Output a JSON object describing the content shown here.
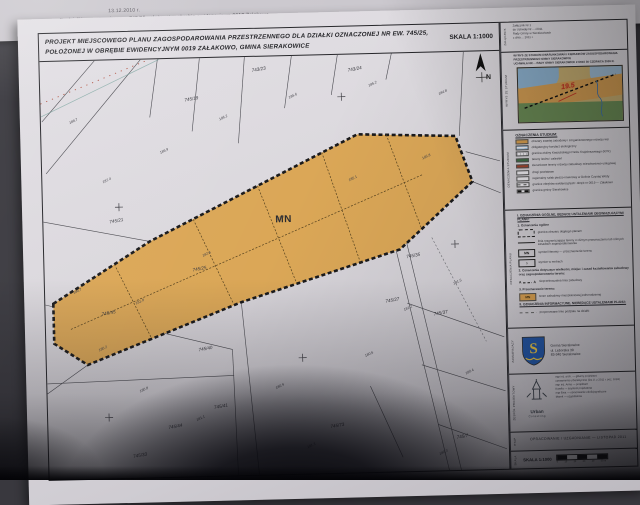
{
  "photo": {
    "back_sheet_lines": [
      "13.12.2010 r.",
      "dla działki oznaczonej nr ew. 745/25 położonej w obrębie ewidencyjnym 0019 Załakowo",
      "oraz Rozporządzenia Rady Ministrów z dnia 7 grudnia 2004 r. w sprawie sposobu i trybu ..."
    ]
  },
  "title_block": {
    "line1": "PROJEKT MIEJSCOWEGO PLANU ZAGOSPODAROWANIA PRZESTRZENNEGO DLA DZIAŁKI OZNACZONEJ NR EW. 745/25,",
    "line2": "POŁOŻONEJ W OBRĘBIE EWIDENCYJNYM 0019 ZAŁAKOWO, GMINA SIERAKOWICE",
    "scale": "SKALA 1:1000"
  },
  "map": {
    "zone_label": "MN",
    "north_label": "N",
    "zone_fill": "#dba757",
    "parcels": [
      {
        "t": "745/25",
        "x": 148,
        "y": 208
      },
      {
        "t": "745/45",
        "x": 56,
        "y": 250
      },
      {
        "t": "745/40",
        "x": 152,
        "y": 288
      },
      {
        "t": "745/41",
        "x": 166,
        "y": 346
      },
      {
        "t": "745/44",
        "x": 120,
        "y": 365
      },
      {
        "t": "745/33",
        "x": 84,
        "y": 393
      },
      {
        "t": "745/73",
        "x": 282,
        "y": 368
      },
      {
        "t": "745/7",
        "x": 408,
        "y": 382
      },
      {
        "t": "745/35",
        "x": 362,
        "y": 200
      },
      {
        "t": "745/27",
        "x": 340,
        "y": 244
      },
      {
        "t": "745/37",
        "x": 388,
        "y": 258
      },
      {
        "t": "745/21",
        "x": 66,
        "y": 158
      },
      {
        "t": "745/19",
        "x": 144,
        "y": 38
      },
      {
        "t": "743/23",
        "x": 212,
        "y": 10
      },
      {
        "t": "743/24",
        "x": 308,
        "y": 12
      }
    ],
    "elevations": [
      {
        "t": "180.2",
        "x": 52,
        "y": 286
      },
      {
        "t": "181.8",
        "x": 90,
        "y": 240
      },
      {
        "t": "182.6",
        "x": 158,
        "y": 194
      },
      {
        "t": "183.4",
        "x": 232,
        "y": 160
      },
      {
        "t": "185.1",
        "x": 306,
        "y": 122
      },
      {
        "t": "185.8",
        "x": 380,
        "y": 102
      },
      {
        "t": "188.7",
        "x": 28,
        "y": 58
      },
      {
        "t": "187.4",
        "x": 60,
        "y": 118
      },
      {
        "t": "186.9",
        "x": 118,
        "y": 90
      },
      {
        "t": "186.2",
        "x": 178,
        "y": 58
      },
      {
        "t": "185.6",
        "x": 248,
        "y": 38
      },
      {
        "t": "185.2",
        "x": 328,
        "y": 28
      },
      {
        "t": "184.8",
        "x": 398,
        "y": 38
      },
      {
        "t": "180.7",
        "x": 28,
        "y": 228
      },
      {
        "t": "180.8",
        "x": 92,
        "y": 328
      },
      {
        "t": "181.1",
        "x": 148,
        "y": 358
      },
      {
        "t": "180.9",
        "x": 228,
        "y": 328
      },
      {
        "t": "181.3",
        "x": 258,
        "y": 388
      },
      {
        "t": "180.6",
        "x": 318,
        "y": 298
      },
      {
        "t": "181.2",
        "x": 358,
        "y": 253
      },
      {
        "t": "181.5",
        "x": 408,
        "y": 228
      },
      {
        "t": "180.4",
        "x": 418,
        "y": 318
      },
      {
        "t": "180.3",
        "x": 390,
        "y": 398
      }
    ]
  },
  "sidebar": {
    "rows_vertical_labels": [
      "ZAŁĄCZNIK",
      "WYRYS ZE STUDIUM",
      "OZNACZENIA STUDIUM",
      "OZNACZENIA PLANU",
      "ZAMAWIAJĄCY",
      "ZESPÓŁ PROJEKTOWY",
      "ETAP",
      "SKALA"
    ],
    "attachment": {
      "lines": [
        "Załącznik Nr 1",
        "do Uchwały Nr ... /2011",
        "Rady Gminy w Sierakowicach",
        "z dnia ... 2011 r."
      ]
    },
    "wyrys": {
      "heading_lines": [
        "WYRYS ZE STUDIUM UWARUNKOWAŃ I KIERUNKÓW ZAGOSPODAROWANIA",
        "PRZESTRZENNEGO GMINY SIERAKOWICE",
        "UCHWAŁA NR ... RADY GMINY SIERAKOWICE Z DNIA 30 CZERWCA 2009 R."
      ],
      "inset_annotation": "19.5"
    },
    "studium": {
      "heading": "OZNACZENIA STUDIUM:",
      "items": [
        {
          "swatch": "orange",
          "label": "obszary zwartej zabudowy i zorganizowanego rozwoju wsi"
        },
        {
          "swatch": "bluestripe",
          "label": "obligatoryjny korytarz ekologiczny"
        },
        {
          "swatch": "graystripe",
          "label": "granica otuliny Kaszubskiego Parku Krajobrazowego (KPK)"
        },
        {
          "swatch": "green",
          "label": "tereny lasów i zalesień"
        },
        {
          "swatch": "brick",
          "label": "kierunkowe tereny rozwoju zabudowy mieszkaniowo-usługowej"
        },
        {
          "swatch": "plain",
          "label": "drogi powiatowe"
        },
        {
          "swatch": "plain",
          "label": "regionalny szlak pieszo-rowerowy w Dolinie Czystej Wody"
        },
        {
          "swatch": "dash",
          "label": "granice obrębów ewidencyjnych: obręb nr 0019 — Załakowo"
        },
        {
          "swatch": "blackdash",
          "label": "granica gminy Sierakowice"
        }
      ]
    },
    "plan": {
      "sections": [
        {
          "kind": "h1",
          "text": "I. OZNACZENIA OGÓLNE, BĘDĄCE USTALENIAMI OBOWIĄZUJĄCYMI PLANU:"
        },
        {
          "kind": "h2",
          "text": "1. Oznaczenia ogólne"
        },
        {
          "kind": "item",
          "symbol": "boundary",
          "label": "granica obszaru objętego planem"
        },
        {
          "kind": "item",
          "symbol": "line",
          "label": "linia rozgraniczająca tereny o różnym przeznaczeniu lub różnych zasadach zagospodarowania"
        },
        {
          "kind": "item",
          "symbol": "mnbox",
          "label": "symbol literowy — przeznaczenie terenu"
        },
        {
          "kind": "item",
          "symbol": "dimbox",
          "label": "wymiar w metrach"
        },
        {
          "kind": "h2",
          "text": "2. Oznaczenia dotyczące wielkości, miejsc i zasad kształtowania zabudowy oraz zagospodarowania terenu:"
        },
        {
          "kind": "item",
          "symbol": "buildline",
          "label": "nieprzekraczalna linia zabudowy"
        },
        {
          "kind": "h2",
          "text": "3. Przeznaczenie terenu:"
        },
        {
          "kind": "item",
          "symbol": "mnswatch",
          "label": "teren zabudowy mieszkaniowej jednorodzinnej"
        },
        {
          "kind": "h1",
          "text": "II. OZNACZENIA INFORMACYJNE, NIEBĘDĄCE USTALENIAMI PLANU:"
        },
        {
          "kind": "item",
          "symbol": "splitdash",
          "label": "proponowane linie podziału na działki"
        }
      ],
      "mn_symbol": "MN",
      "dim_symbol": "5",
      "buildline_letters": "A"
    },
    "client": {
      "name": "Gmina Sierakowice",
      "address1": "ul. Lęborska 30",
      "address2": "83-340 Sierakowice"
    },
    "team": {
      "logo_title": "Urban",
      "logo_subtitle": "Consulting",
      "lines": [
        "mgr inż. arch. — główny projektant",
        "uprawnienia urbanistyczne (Dz.U. z 2011 r. poz. 1033)",
        "mgr inż. Anna — projektant",
        "Kamila — asystent projektanta",
        "mgr Ewa — opracowanie ekofizjograficzne",
        "Marek — uzgodnienia"
      ]
    },
    "stage": {
      "text": "OPRACOWANIE / UZGADNIANIE — LISTOPAD 2011"
    },
    "scale_row": {
      "label": "SKALA 1:1000",
      "ticks": [
        "0",
        "10",
        "20",
        "30",
        "40",
        "50 m"
      ]
    }
  }
}
